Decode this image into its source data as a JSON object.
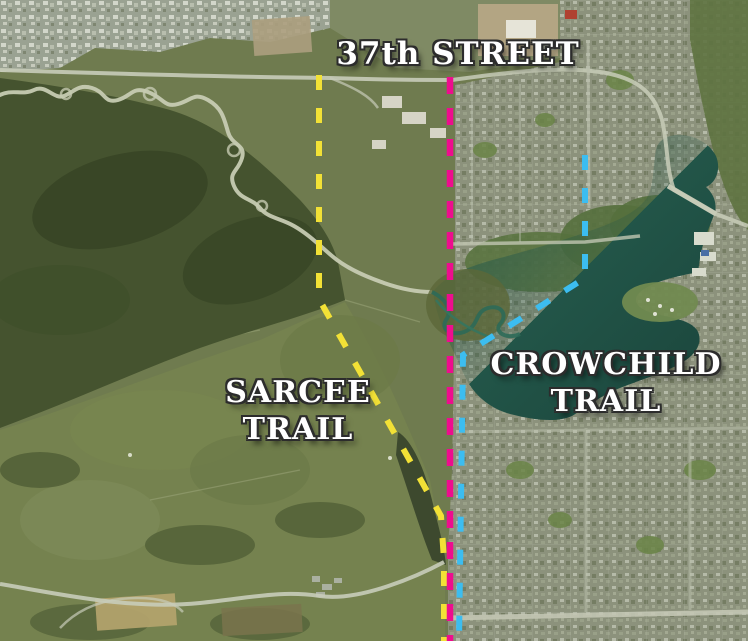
{
  "labels": {
    "street37": {
      "text": "37th STREET"
    },
    "sarcee": {
      "line1": "SARCEE",
      "line2": "TRAIL"
    },
    "crowchild": {
      "line1": "CROWCHILD",
      "line2": "TRAIL"
    }
  },
  "trails": {
    "street37": {
      "name": "37th Street",
      "color": "#ee0d8e",
      "path": "M450 77 L450 641"
    },
    "sarcee": {
      "name": "Sarcee Trail",
      "color": "#f2e136",
      "path": "M319 75 L319 299 L441 516 L444 560 L444 641"
    },
    "crowchild": {
      "name": "Crowchild Trail",
      "color": "#3cbdf0",
      "path": "M585 155 L585 278 L463 355 L459 641"
    }
  }
}
